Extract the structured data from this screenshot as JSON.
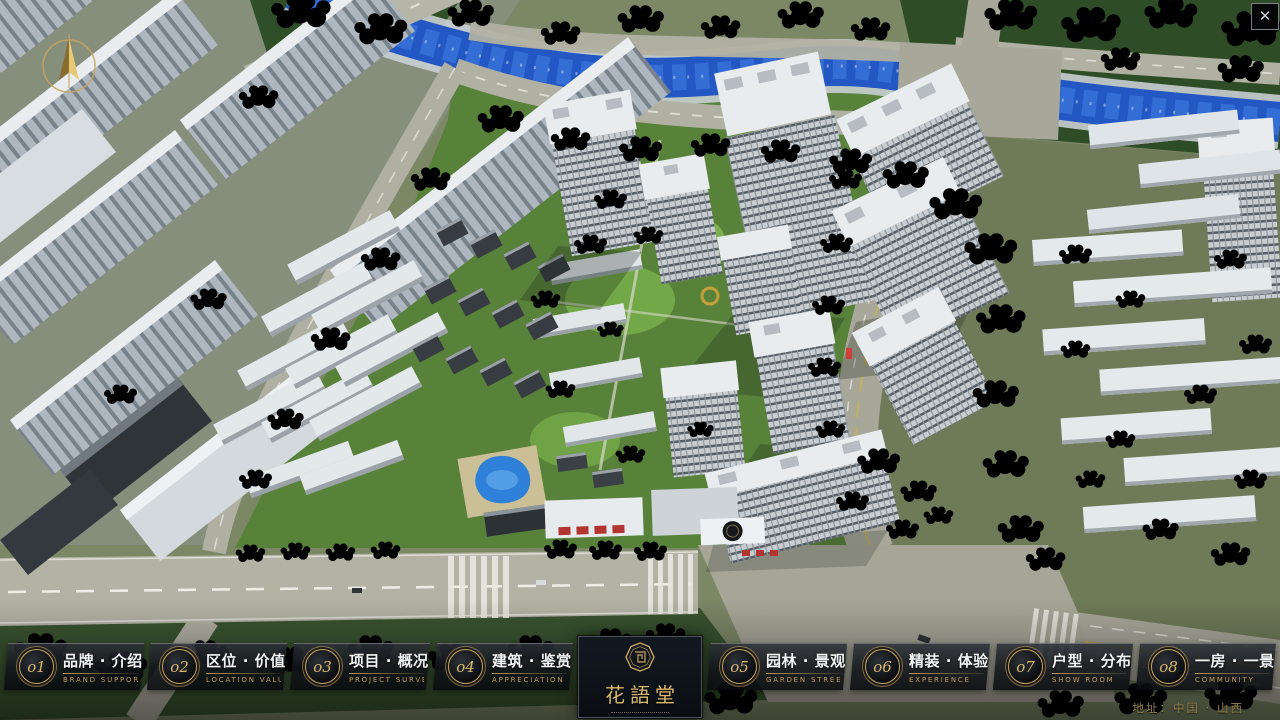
{
  "window": {
    "close": "✕"
  },
  "nav": {
    "items": [
      {
        "num": "o1",
        "cn": "品牌 · 介绍",
        "en": "BRAND SUPPORT"
      },
      {
        "num": "o2",
        "cn": "区位 · 价值",
        "en": "LOCATION VALUE"
      },
      {
        "num": "o3",
        "cn": "项目 · 概况",
        "en": "PROJECT SURVEY"
      },
      {
        "num": "o4",
        "cn": "建筑 · 鉴赏",
        "en": "APPRECIATION"
      },
      {
        "num": "o5",
        "cn": "园林 · 景观",
        "en": "GARDEN STREET"
      },
      {
        "num": "o6",
        "cn": "精装 · 体验",
        "en": "EXPERIENCE"
      },
      {
        "num": "o7",
        "cn": "户型 · 分布",
        "en": "SHOW ROOM"
      },
      {
        "num": "o8",
        "cn": "一房 · 一景",
        "en": "COMMUNITY"
      }
    ]
  },
  "logo": {
    "title": "花語堂"
  },
  "footer": {
    "address": "地址：中国 · 山西"
  },
  "colors": {
    "gold": "#c8a35f",
    "panel": "rgba(14,17,22,0.86)",
    "river": "#2257c4"
  }
}
